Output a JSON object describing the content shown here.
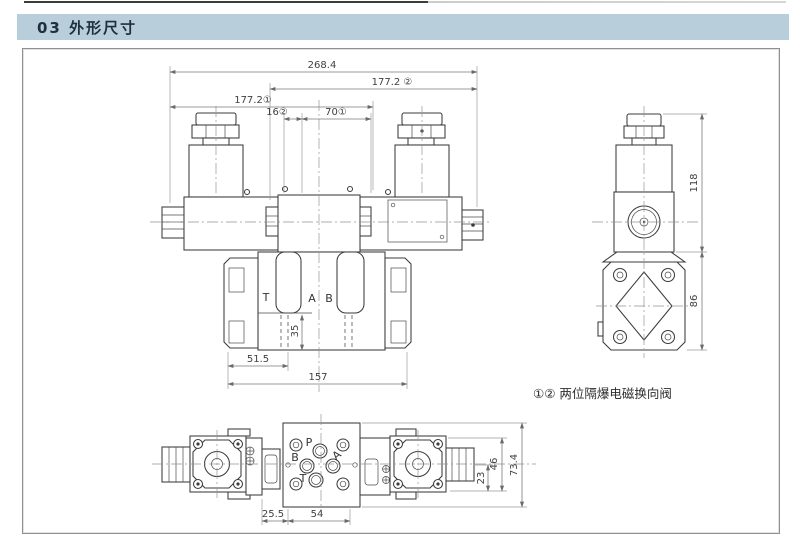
{
  "page": {
    "header_title": "03 外形尺寸"
  },
  "colors": {
    "header_bg": "#b9cedb",
    "header_text": "#20303a",
    "line": "#3b3b3b",
    "dimension": "#7a7a7a"
  },
  "drawing": {
    "caption": "①② 两位隔爆电磁换向阀",
    "front_view": {
      "ports": {
        "t": "T",
        "a": "A",
        "b": "B"
      },
      "dims": {
        "total_width": "268.4",
        "width_2": "177.2 ②",
        "width_1": "177.2①",
        "offset_16": "16②",
        "offset_70": "70①",
        "depth_35": "35",
        "left_51_5": "51.5",
        "base_157": "157"
      }
    },
    "side_view": {
      "dims": {
        "height_118": "118",
        "height_86": "86"
      }
    },
    "bottom_view": {
      "ports": {
        "p": "P",
        "a": "A",
        "b": "B",
        "t": "T"
      },
      "dims": {
        "d_25_5": "25.5",
        "d_54": "54",
        "d_23": "23",
        "d_46": "46",
        "d_73_4": "73.4"
      }
    }
  }
}
